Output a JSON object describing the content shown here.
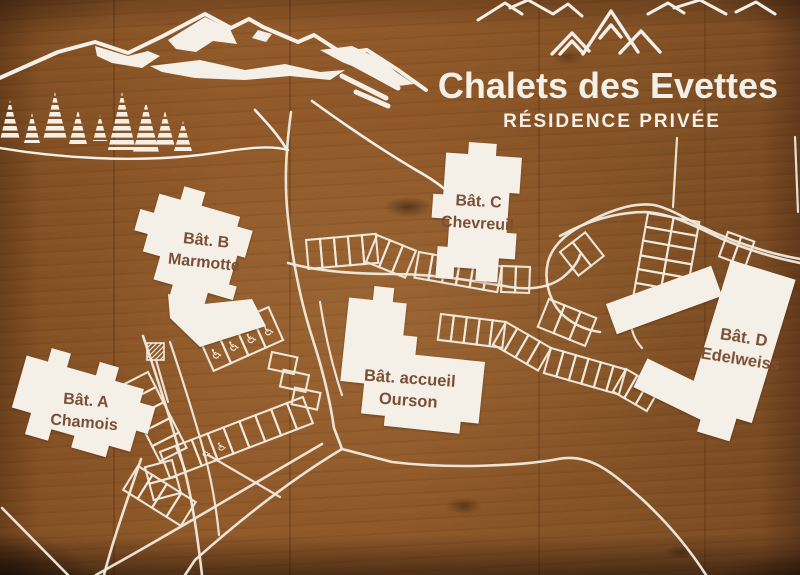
{
  "sign": {
    "title": "Chalets des Evettes",
    "subtitle": "RÉSIDENCE PRIVÉE"
  },
  "buildings": {
    "a": {
      "line1": "Bât. A",
      "line2": "Chamois"
    },
    "b": {
      "line1": "Bât. B",
      "line2": "Marmotte"
    },
    "c": {
      "line1": "Bât. C",
      "line2": "Chevreuil"
    },
    "accueil": {
      "line1": "Bât. accueil",
      "line2": "Ourson"
    },
    "d": {
      "line1": "Bât. D",
      "line2": "Edelweiss"
    }
  },
  "icons": {
    "accessible_parking": "♿",
    "mountain_logo": "three-mountain-peaks",
    "mountain_scene": "mountain-ridge-with-snow-and-pines"
  },
  "colors": {
    "wood_brown": "#8a5527",
    "paint_white": "#f5f0e7",
    "label_brown": "#7b4f35"
  }
}
